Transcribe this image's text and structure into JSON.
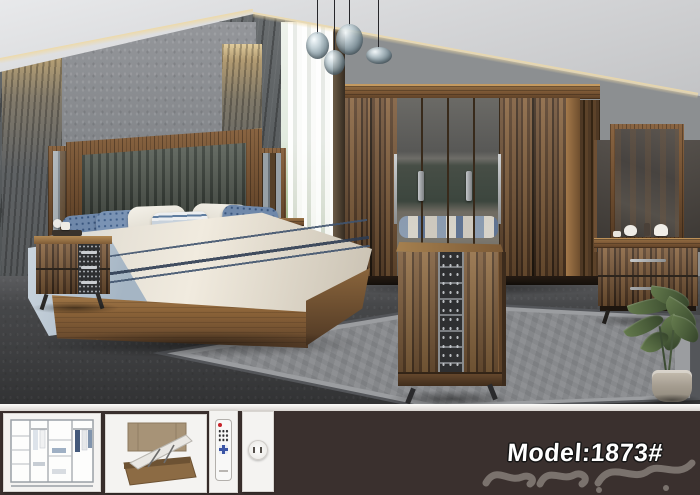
{
  "page": {
    "type": "furniture-product-photo",
    "subject": "bedroom set showroom scene"
  },
  "footer": {
    "model_label": "Model:1873#",
    "background_color": "#3a302e",
    "divider_color": "#efece8",
    "watermark": {
      "name": "arabic-calligraphy-watermark",
      "color": "#948d88"
    },
    "thumbnails": [
      {
        "name": "wardrobe-interior-diagram"
      },
      {
        "name": "bed-lift-storage-diagram"
      },
      {
        "name": "led-remote-control"
      },
      {
        "name": "round-wall-socket"
      }
    ]
  },
  "scene": {
    "objects": [
      "pendant-glass-lamps",
      "stone-accent-wall",
      "sheer-window-curtain",
      "upholstered-king-bed",
      "wall-mirror-panel-left",
      "wall-mirror-panel-right",
      "nightstand-left",
      "nightstand-right",
      "six-door-mirrored-wardrobe",
      "dresser-with-mirror",
      "tallboy-chest",
      "gray-area-rug",
      "potted-plant"
    ],
    "palette": {
      "walnut_dark": "#4a3321",
      "walnut_light": "#86613c",
      "oak_base": "#a27a48",
      "stone_gray": "#5d6163",
      "wall_gray": "#919496",
      "floor_gray": "#414244",
      "rug_gray": "#85878a",
      "bedding_cream": "#efe9dd",
      "pillow_blue": "#6f88aa",
      "navy_stripe": "#2e3c52",
      "leaf_green": "#52663f",
      "cove_light": "#e5d3a5"
    }
  }
}
